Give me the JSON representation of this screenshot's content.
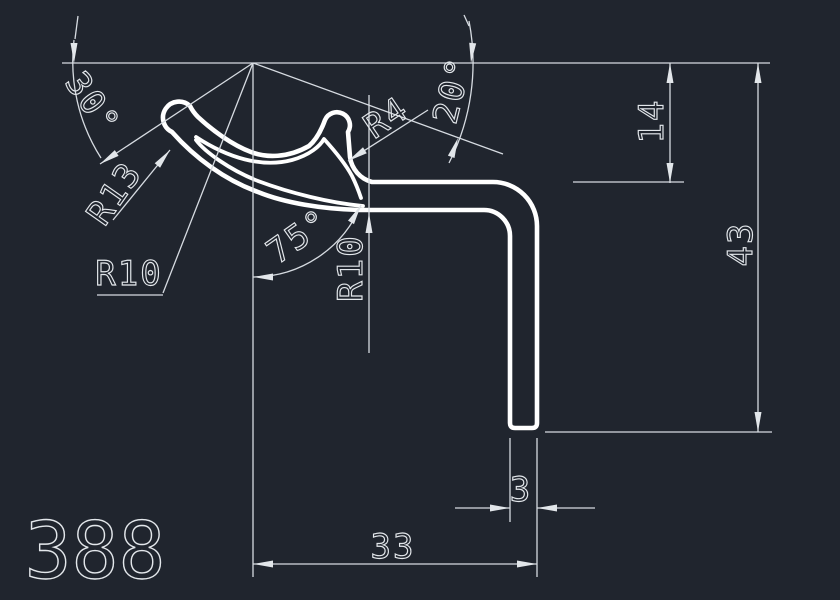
{
  "drawing": {
    "part_number": "388",
    "colors": {
      "background": "#20252e",
      "geometry": "#ffffff",
      "dimensions": "#d9dee4"
    },
    "callouts": {
      "angle_30": "30°",
      "radius_13": "R13",
      "radius_10_left": "R10",
      "angle_75": "75°",
      "radius_10_right": "R10",
      "radius_4": "R4",
      "angle_20": "20°"
    },
    "linear_dimensions": {
      "upper_height": "14",
      "total_height": "43",
      "wall_thickness": "3",
      "overall_width": "33"
    }
  }
}
